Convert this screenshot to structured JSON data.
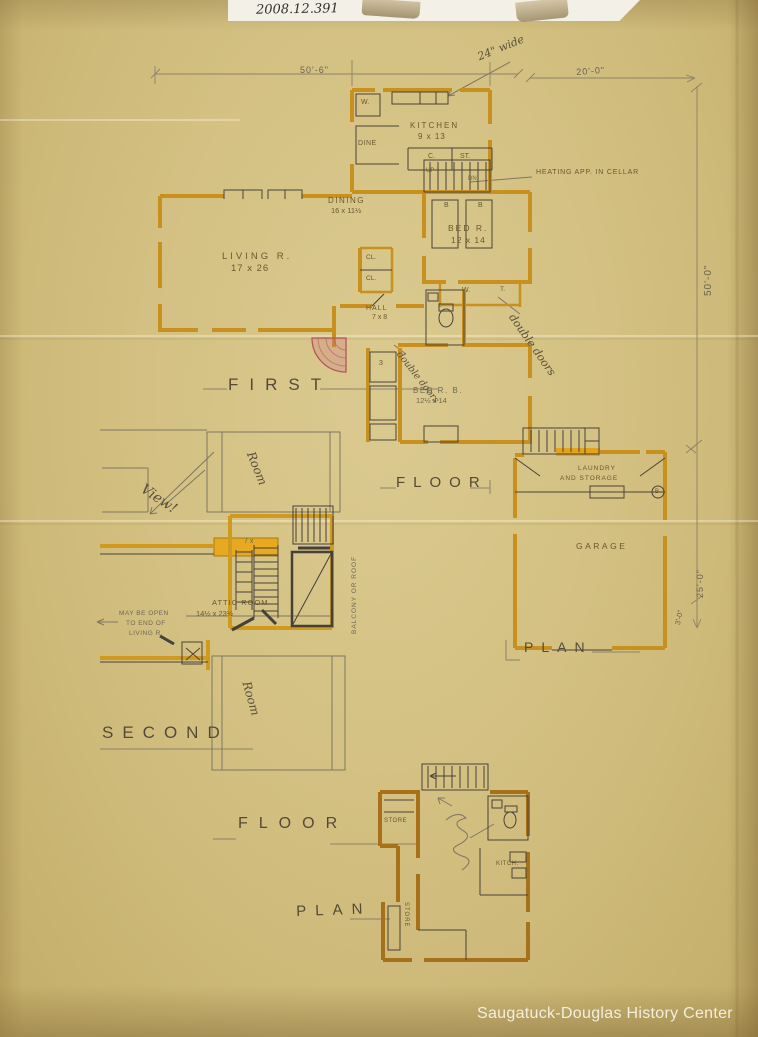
{
  "colors": {
    "paper": "#d2bf80",
    "wall_orange": "#c8901e",
    "highlight_yellow": "#e7a91f",
    "door_red": "#b5565e",
    "ink": "#4a4238"
  },
  "header": {
    "catalog_number": "2008.12.391"
  },
  "watermark": {
    "text": "Saugatuck-Douglas History Center"
  },
  "first_floor": {
    "title": {
      "word1": "FIRST",
      "word2": "FLOOR",
      "word3": "PLAN"
    },
    "dimensions": {
      "top_left": "50'-6\"",
      "top_right": "20'-0\"",
      "right_upper": "50'-0\"",
      "right_lower": "25'-0\"",
      "right_bottom": "3'-0\""
    },
    "rooms": {
      "kitchen_name": "KITCHEN",
      "kitchen_size": "9 x 13",
      "dine": "DINE",
      "dining_name": "DINING",
      "dining_size": "16 x 11½",
      "living_name": "LIVING R.",
      "living_size": "17 x 26",
      "hall_name": "HALL",
      "hall_size": "7 x 8",
      "bed1_name": "BED R.",
      "bed1_size": "12 x 14",
      "bed2_name": "BED R. B.",
      "bed2_size": "12½ x 14",
      "garage": "GARAGE",
      "laundry_line1": "LAUNDRY",
      "laundry_line2": "AND STORAGE"
    },
    "small_labels": {
      "w_kitchen": "W.",
      "closet_c": "C.",
      "closet_st": "ST.",
      "up": "UP",
      "down": "DN",
      "cl_1": "CL.",
      "cl_2": "CL.",
      "w_bed": "W.",
      "t_closet": "T.",
      "bed_b1": "B",
      "bed_b2": "B",
      "steps": "3",
      "garage_b": "B"
    },
    "notes": {
      "heating": "HEATING APP. IN CELLAR",
      "pencil_wide": "24\" wide",
      "pencil_double_doors_1": "double doors",
      "pencil_double_doors_2": "double doors"
    }
  },
  "second_floor": {
    "title": {
      "word1": "SECOND",
      "word2": "FLOOR",
      "word3": "PLAN"
    },
    "rooms": {
      "attic_name": "ATTIC ROOM",
      "attic_size": "14½ x 23½"
    },
    "notes": {
      "open_line1": "MAY BE OPEN",
      "open_line2": "TO END OF",
      "open_line3": "LIVING R.",
      "balcony": "BALCONY OR ROOF",
      "view": "View!",
      "room_upper": "Room",
      "room_lower": "Room",
      "stair_size": "7 x"
    }
  },
  "cellar": {
    "labels": {
      "store_left": "STORE",
      "kitch": "KITCH.",
      "store_bottom": "STORE"
    }
  }
}
